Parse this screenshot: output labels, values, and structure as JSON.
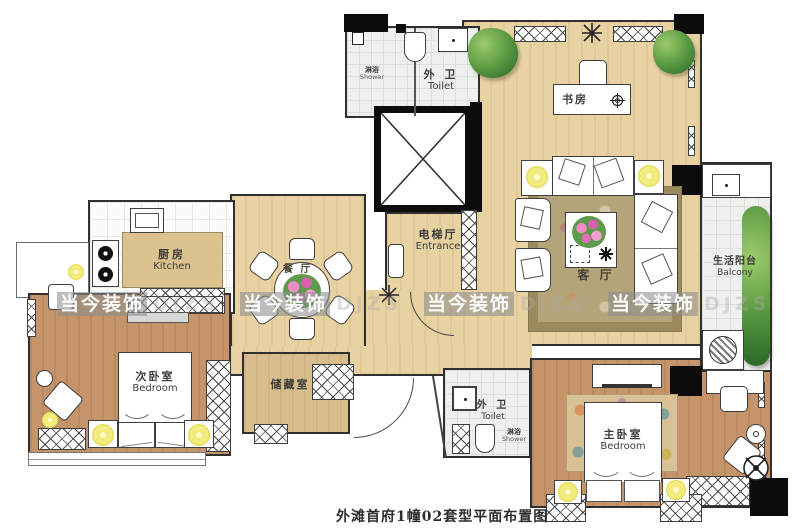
{
  "caption": "外滩首府1幢02套型平面布置图",
  "watermark": {
    "text": "当今装饰",
    "latin": "DJZS"
  },
  "rooms": {
    "toilet_top": {
      "zh": "外 卫",
      "en": "Toilet"
    },
    "shower_top": {
      "zh": "淋浴",
      "en": "Shower"
    },
    "study": {
      "zh": "书房"
    },
    "entrance": {
      "zh": "电梯厅",
      "en": "Entrance"
    },
    "kitchen": {
      "zh": "厨房",
      "en": "Kitchen"
    },
    "dining": {
      "zh": "餐 厅"
    },
    "living": {
      "zh": "客 厅"
    },
    "balcony": {
      "zh": "生活阳台",
      "en": "Balcony"
    },
    "bedroom2": {
      "zh": "次卧室",
      "en": "Bedroom"
    },
    "storage": {
      "zh": "储藏室"
    },
    "toilet_bottom": {
      "zh": "外 卫",
      "en": "Toilet"
    },
    "shower_bottom": {
      "zh": "淋浴",
      "en": "Shower"
    },
    "master": {
      "zh": "主卧室",
      "en": "Bedroom"
    }
  },
  "colors": {
    "wood_light": "#e8d2a2",
    "wood_dark": "#c6946a",
    "wood_mid": "#d8bd8d",
    "tile": "#eef0ee",
    "wall": "#1a1a1a",
    "living_carpet": "#b1a077",
    "lamp_yellow": "#f2ec7e",
    "plant_green": "#55953f",
    "flower_pink": "#e07ab8",
    "watermark_bg": "rgba(142,142,142,0.58)"
  }
}
